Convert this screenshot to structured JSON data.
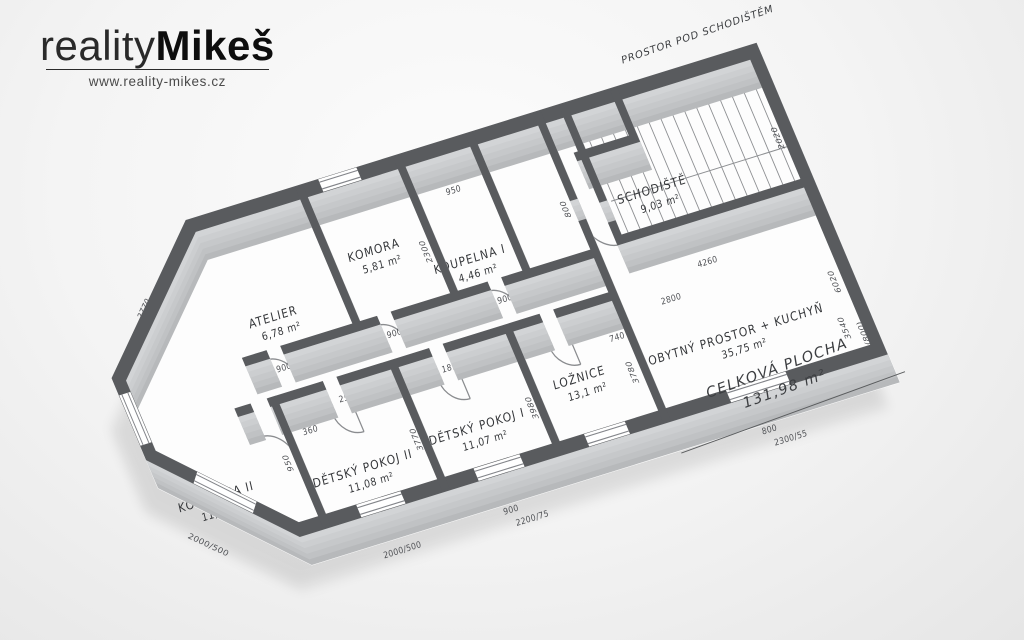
{
  "brand": {
    "logo_light": "reality",
    "logo_bold": "Mikeš",
    "url": "www.reality-mikes.cz"
  },
  "plan": {
    "rooms": [
      {
        "name": "KOUPELNA II",
        "area": "11,73 m²"
      },
      {
        "name": "DĚTSKÝ POKOJ II",
        "area": "11,08 m²"
      },
      {
        "name": "DĚTSKÝ POKOJ I",
        "area": "11,07 m²"
      },
      {
        "name": "LOŽNICE",
        "area": "13,1 m²"
      },
      {
        "name": "ATELIER",
        "area": "6,78 m²"
      },
      {
        "name": "KOMORA",
        "area": "5,81 m²"
      },
      {
        "name": "KOUPELNA I",
        "area": "4,46 m²"
      },
      {
        "name": "CHODBA",
        "area": "m²"
      },
      {
        "name": "OBYTNÝ PROSTOR + KUCHYŇ",
        "area": "35,75 m²"
      },
      {
        "name": "SCHODIŠTĚ",
        "area": "9,03 m²"
      }
    ],
    "annotations": {
      "under_stairs": "PROSTOR POD SCHODIŠTĚM",
      "total_label": "CELKOVÁ PLOCHA",
      "total_value": "131,98 m²"
    },
    "dimensions": [
      "2770",
      "1370",
      "440",
      "2000/500",
      "2550",
      "1920",
      "900",
      "900",
      "2300",
      "950",
      "900",
      "800",
      "1970",
      "4260",
      "2020",
      "6020",
      "2800",
      "3540",
      "450 (800)",
      "3780",
      "3770",
      "1890",
      "3980",
      "1540",
      "740",
      "900",
      "2200/75",
      "800",
      "2300/55",
      "2000/500",
      "360",
      "950",
      "900"
    ],
    "colors": {
      "wall_top": "#595b5e",
      "wall_side": "#c3c5c7",
      "floor": "#fdfdfd",
      "ink": "#3c3e41",
      "background": "#f2f2f2"
    }
  }
}
